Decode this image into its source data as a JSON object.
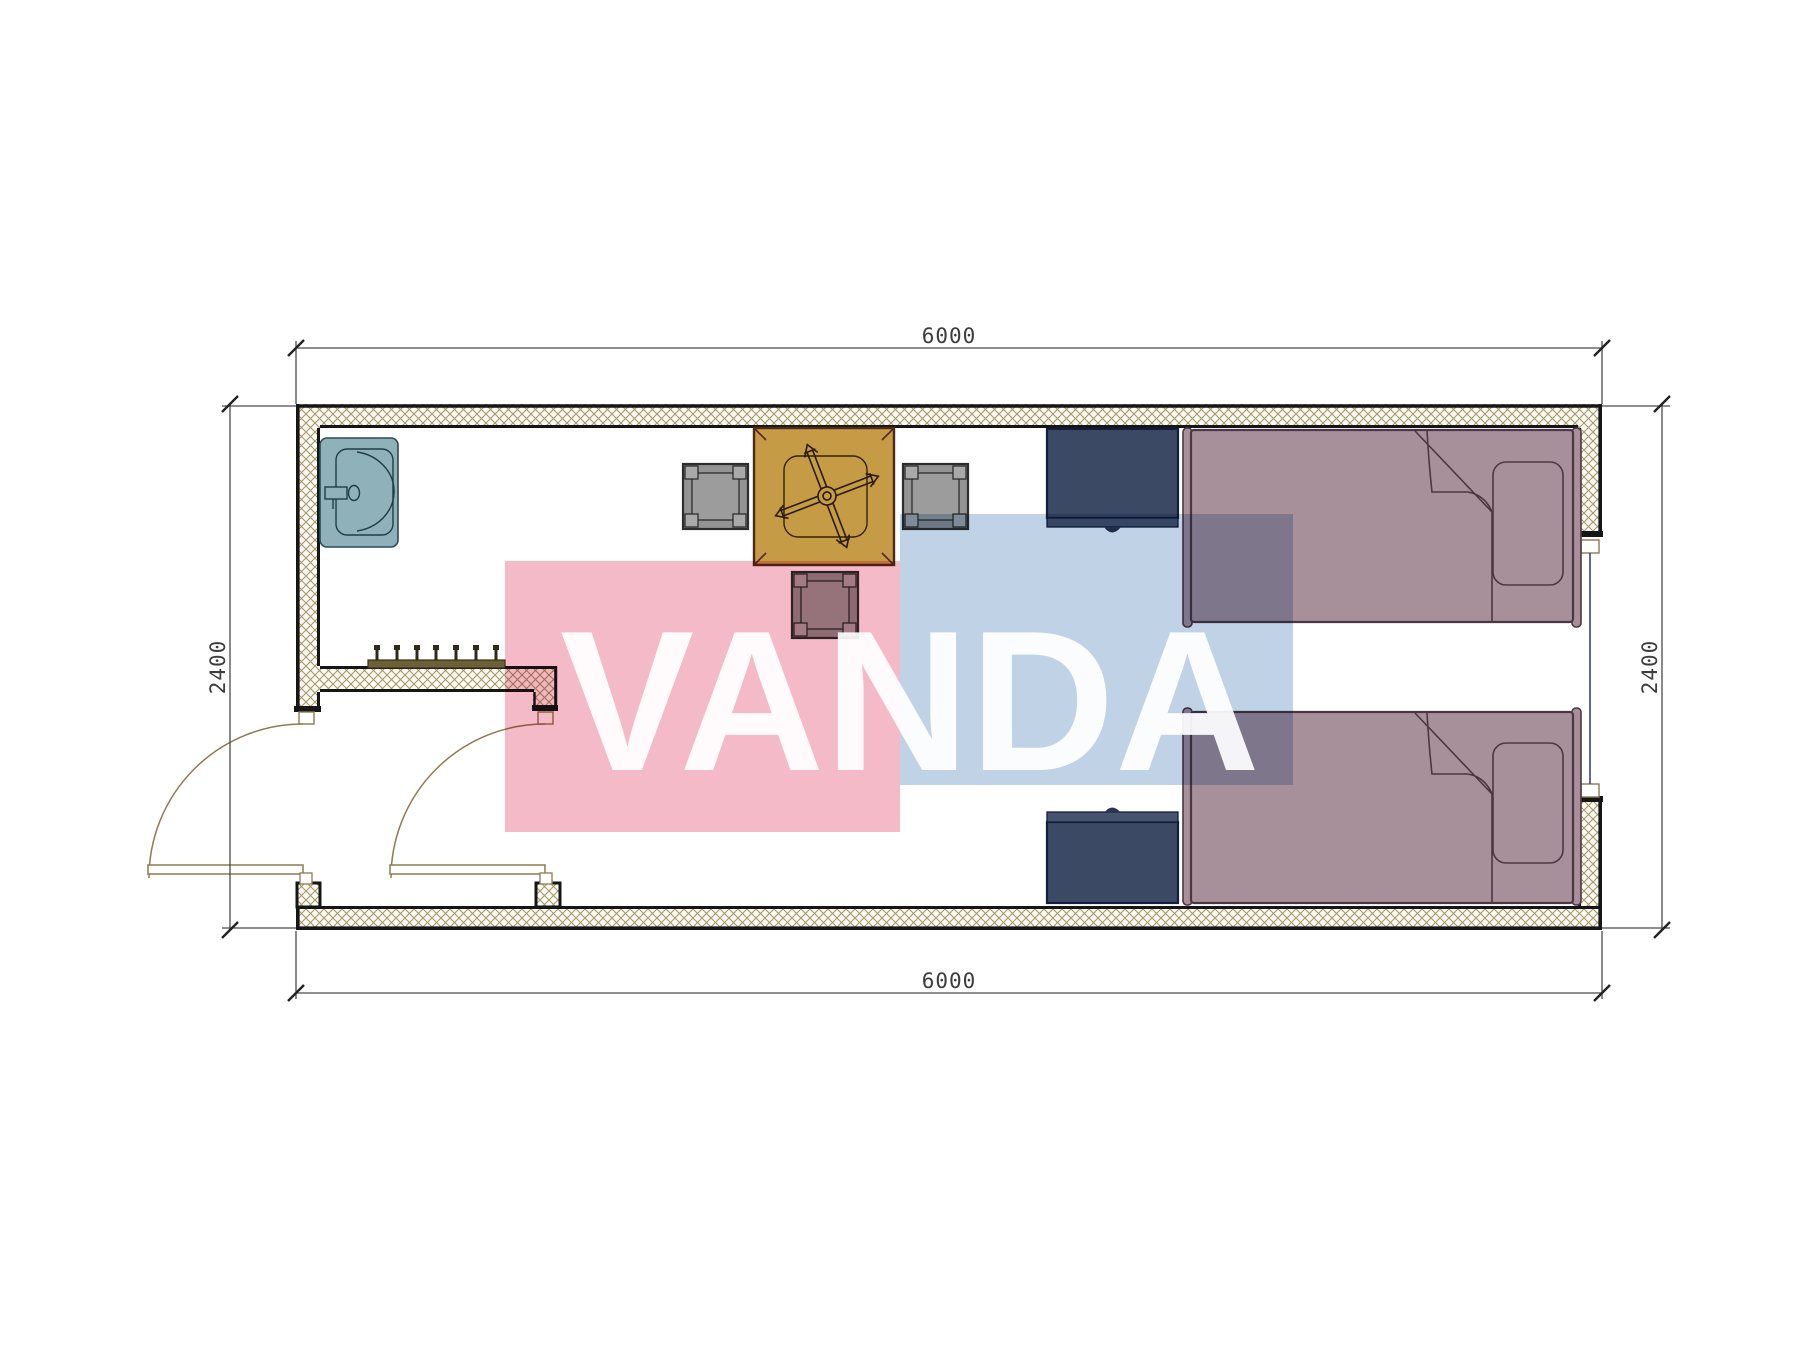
{
  "drawing": {
    "type": "architectural floor plan of a 6000x2400 container room",
    "unit": "mm",
    "dimensions": {
      "top": "6000",
      "bottom": "6000",
      "left": "2400",
      "right": "2400"
    },
    "openings": {
      "entry_door_outer": "hinged door in left wall, quarter-circle swing",
      "entry_door_inner": "hinged door at vestibule partition, quarter-circle swing",
      "window_right": "window centered in right wall"
    },
    "furniture": [
      "wash-basin (top-left corner)",
      "square table with rotated cross / fan motif",
      "chair-left",
      "chair-right",
      "chair-bottom",
      "navy cabinet top",
      "navy cabinet bottom",
      "single bed top (pillow right, folded blanket corner)",
      "single bed bottom (pillow right, folded blanket corner)",
      "coat rack with 7 hooks on vestibule partition"
    ]
  },
  "watermark": {
    "text": "VANDA",
    "pink_rect": "#f5bac7",
    "blue_rect": "#c0d2e6",
    "letter_color": "rgba(255,255,255,0.92)"
  },
  "colors": {
    "wall_hatch_line": "#a5986c",
    "wall_hatch_bg": "#fcfaf3",
    "wall_edge": "#161616",
    "door_symbol": "#8d7b4e",
    "window_glass": "#3d3d85",
    "dimension_line": "#4a4a4a",
    "sink": "#8fb1ba",
    "table": "#c59b45",
    "chair": "#939393",
    "bed": "#a8909b",
    "cabinet": "#3c4964",
    "coat_rack": "#6c6036"
  }
}
